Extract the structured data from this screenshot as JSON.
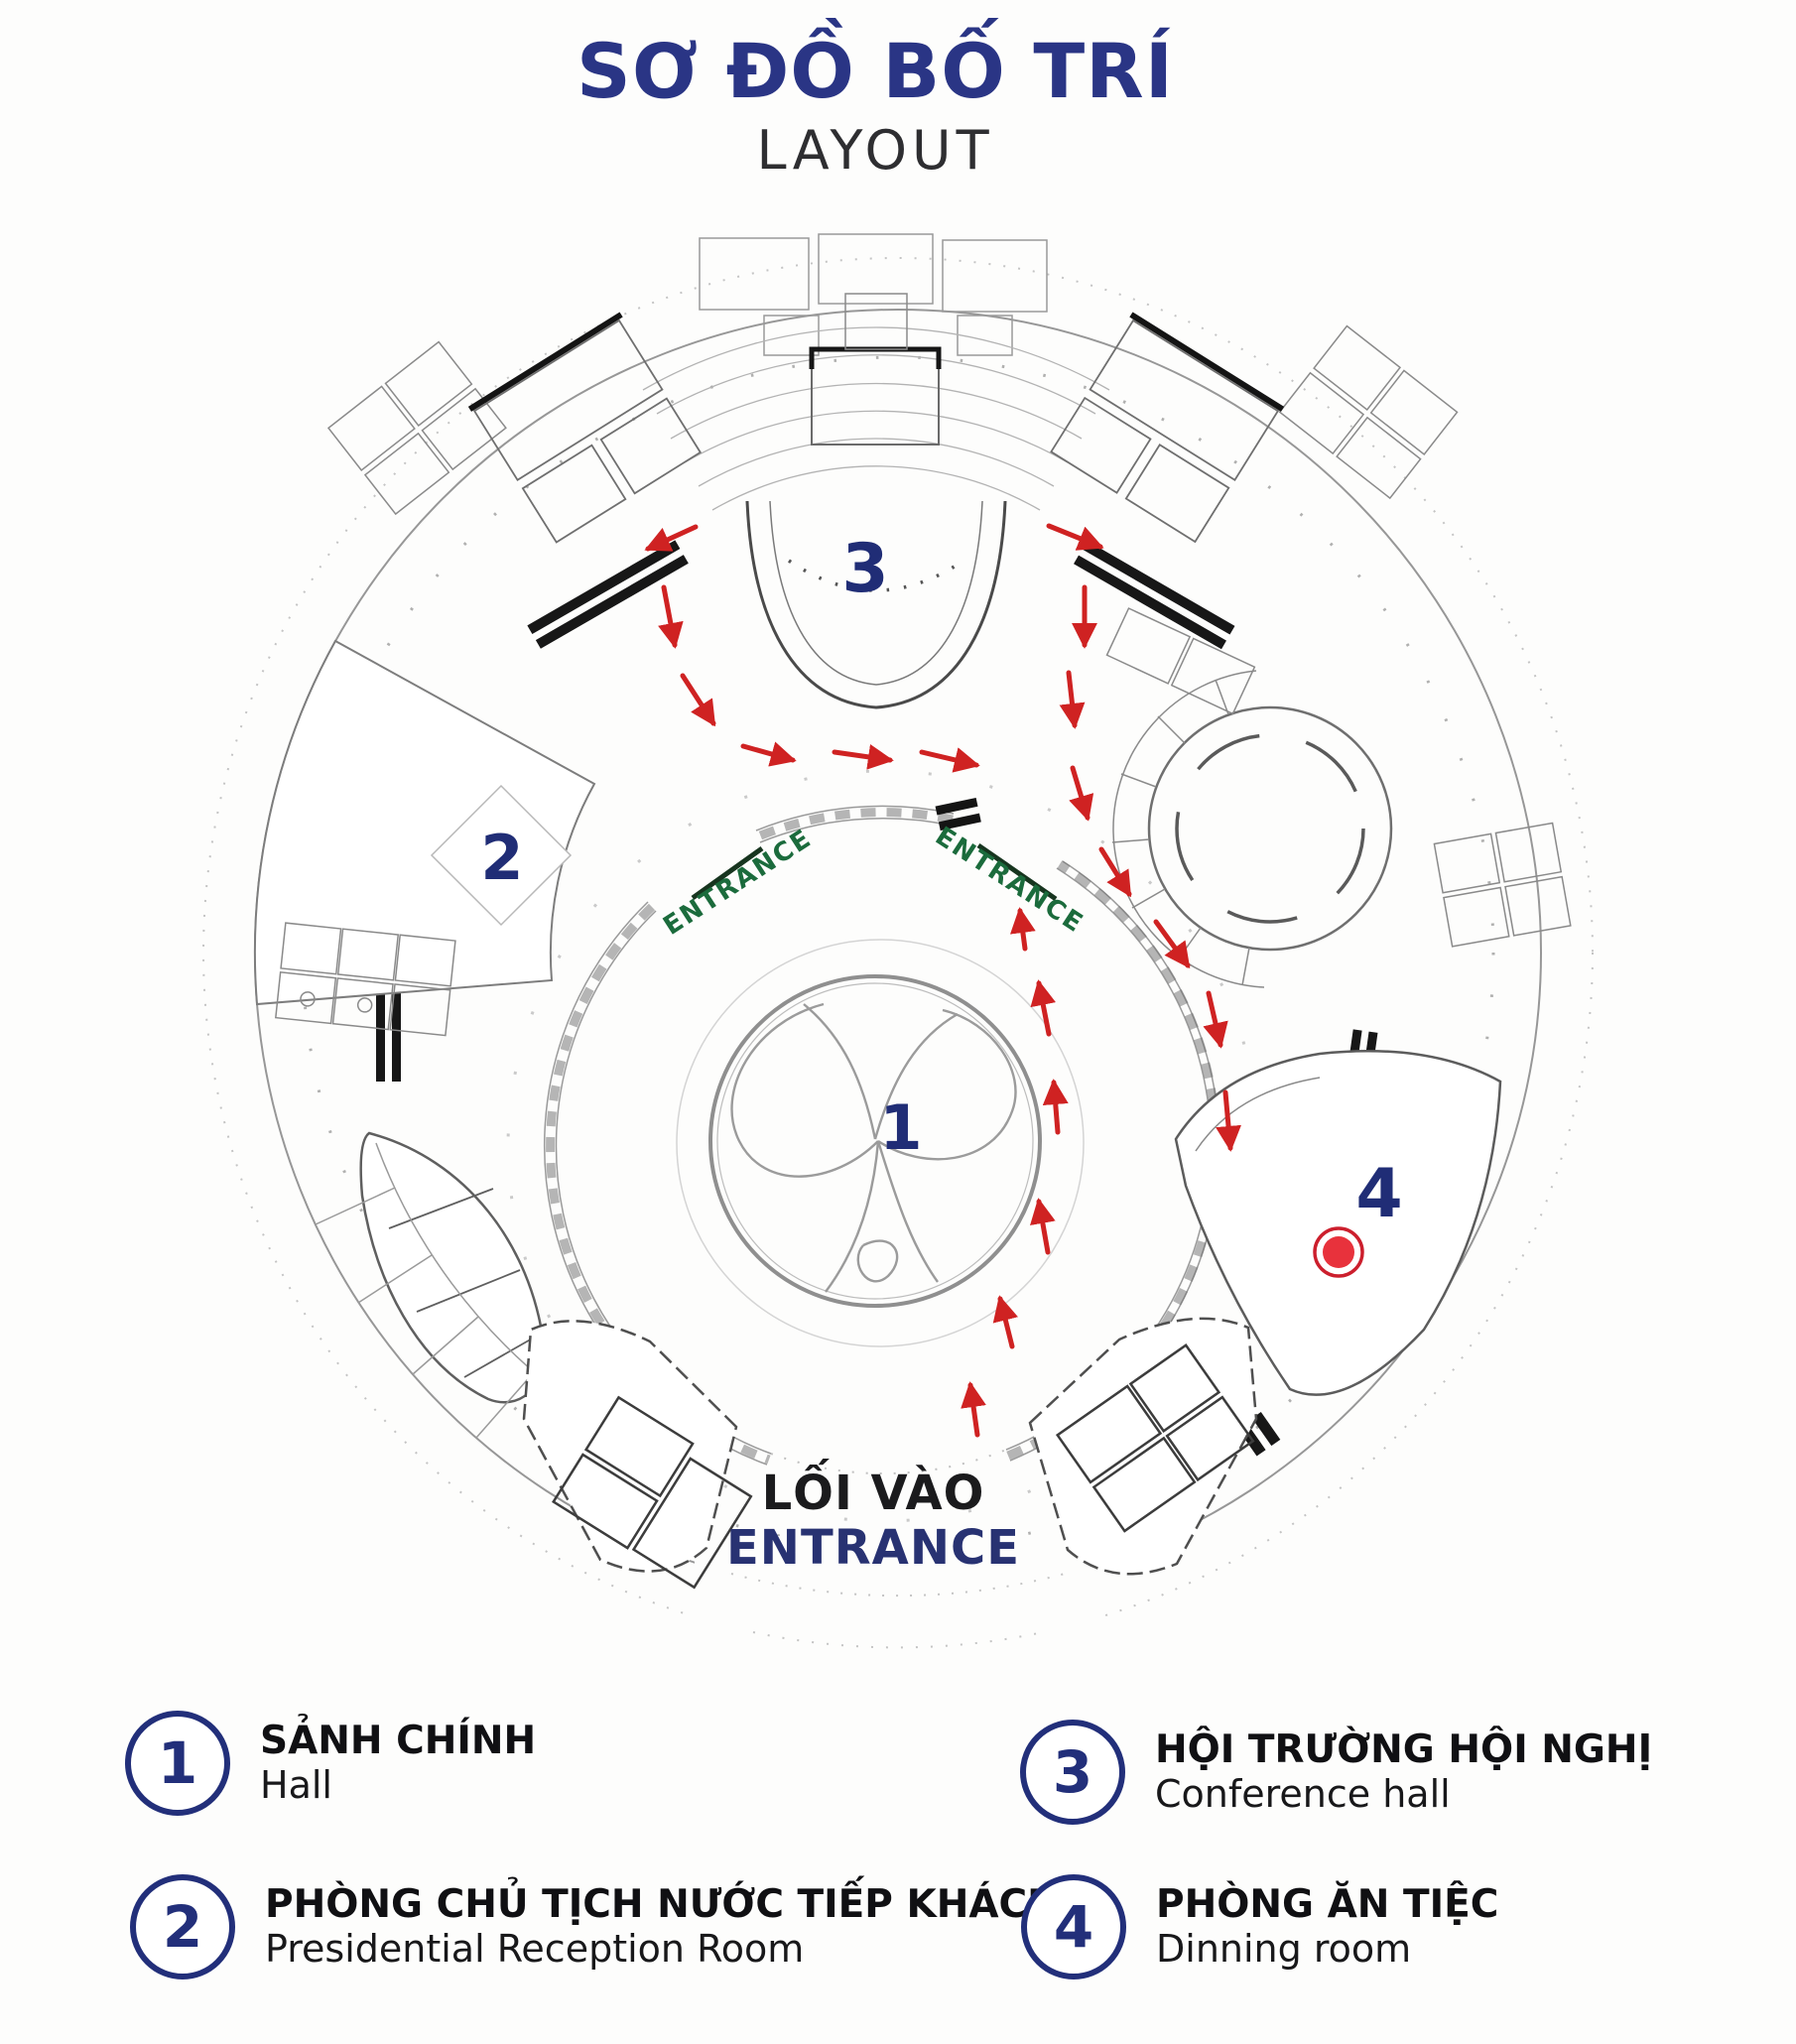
{
  "header": {
    "title": "SƠ ĐỒ BỐ TRÍ",
    "subtitle": "LAYOUT"
  },
  "plan": {
    "markers": {
      "hall": "1",
      "reception": "2",
      "conference": "3",
      "dining": "4"
    },
    "entrances": {
      "left_label": "ENTRANCE",
      "right_label": "ENTRANCE"
    },
    "main_entrance": {
      "line1": "LỐI VÀO",
      "line2": "ENTRANCE"
    },
    "colors": {
      "marker_navy": "#202d76",
      "route_red": "#cf2222",
      "entrance_green": "#1b6b3c",
      "dot_red": "#e8323c",
      "title_navy": "#2a3585"
    }
  },
  "legend": {
    "items": [
      {
        "number": "1",
        "title": "SẢNH CHÍNH",
        "subtitle": "Hall"
      },
      {
        "number": "2",
        "title": "PHÒNG CHỦ TỊCH NƯỚC TIẾP KHÁCH",
        "subtitle": "Presidential Reception Room"
      },
      {
        "number": "3",
        "title": "HỘI TRƯỜNG HỘI NGHỊ",
        "subtitle": "Conference hall"
      },
      {
        "number": "4",
        "title": "PHÒNG ĂN TIỆC",
        "subtitle": "Dinning room"
      }
    ]
  }
}
